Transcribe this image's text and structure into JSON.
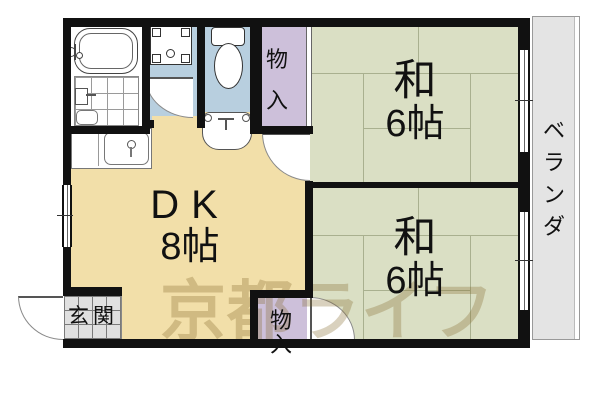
{
  "watermark": "京都ライフ",
  "rooms": {
    "dk": {
      "name": "DK",
      "size": "8帖"
    },
    "washitsu_top": {
      "name": "和",
      "size": "6帖"
    },
    "washitsu_bottom": {
      "name": "和",
      "size": "6帖"
    },
    "closet_top": {
      "label": "物入"
    },
    "closet_bottom": {
      "label": "物入"
    },
    "genkan": {
      "label": "玄関"
    },
    "veranda": {
      "label": "ベランダ"
    }
  },
  "icons": [
    "bathtub-icon",
    "bathroom-tile-icon",
    "bath-faucet-icon",
    "washing-machine-pan-icon",
    "toilet-icon",
    "washbasin-icon",
    "kitchen-sink-icon",
    "door-swing-icon",
    "entrance-door-icon",
    "window-icon"
  ],
  "colors": {
    "wall": "#111111",
    "dk_floor": "#f2dfa9",
    "tatami_floor": "#dadfc4",
    "tatami_line": "#a9b08f",
    "wet_area_floor": "#b8cfdf",
    "closet_floor": "#cdc0da",
    "veranda_floor": "#e4e4e4",
    "genkan_tile": "#e0e0e0",
    "watermark_text": "rgba(128,104,40,0.3)"
  }
}
